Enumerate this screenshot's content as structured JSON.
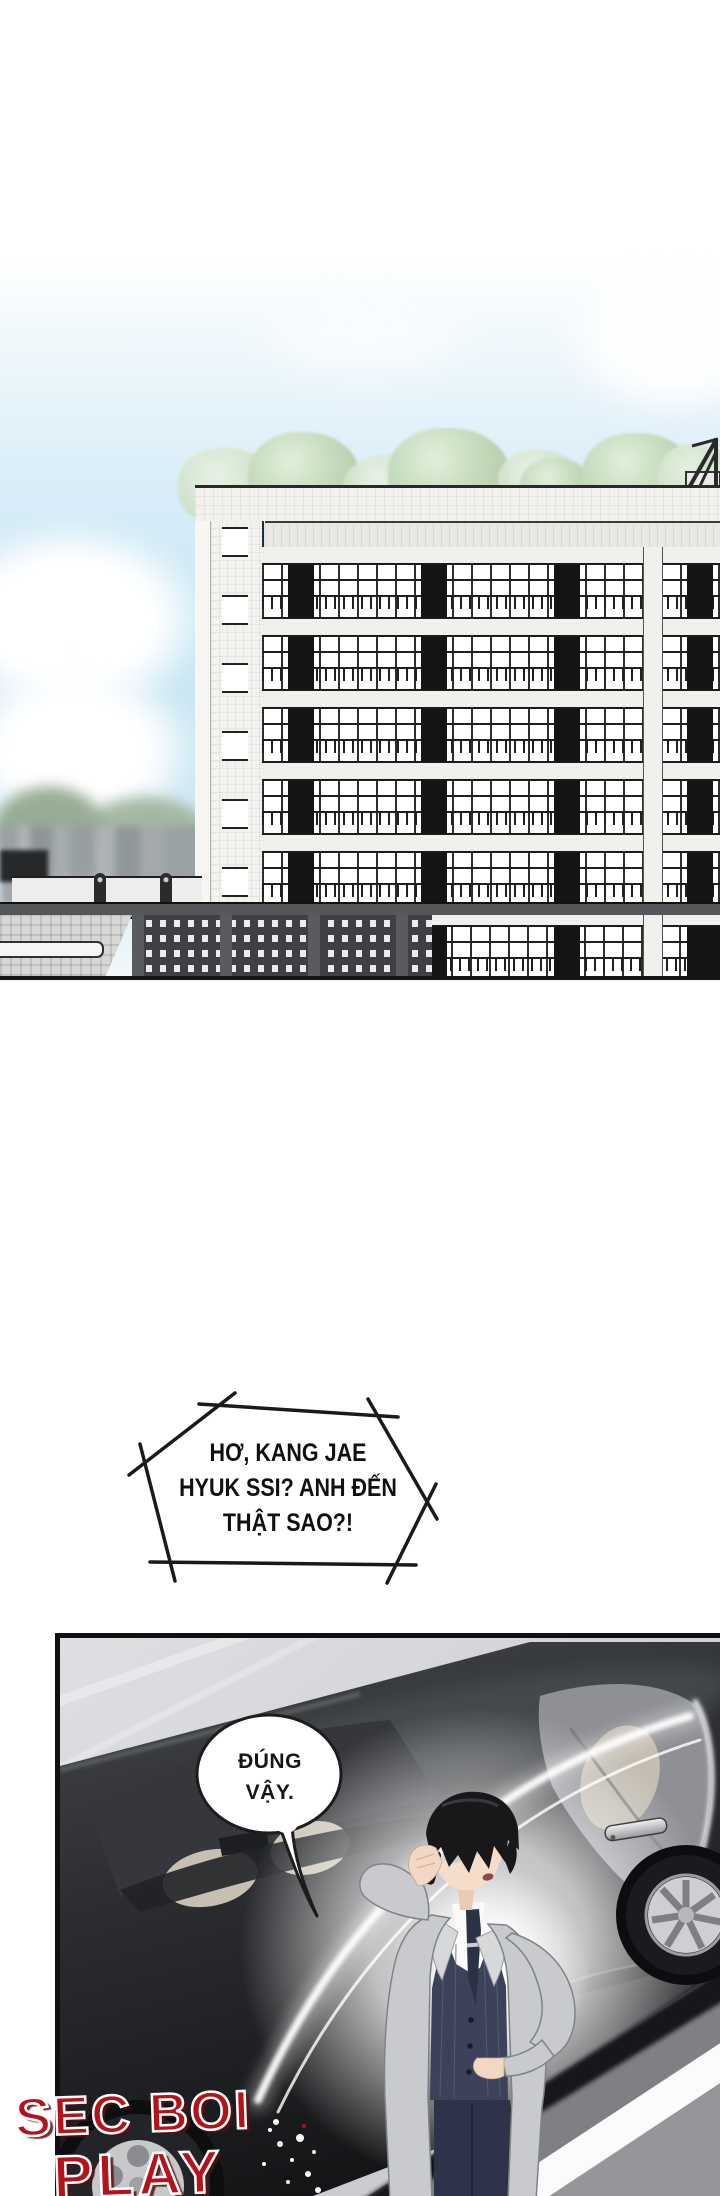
{
  "bubbles": {
    "shout": {
      "lines": [
        "HƠ, KANG JAE",
        "HYUK SSI? ANH ĐẾN",
        "THẬT SAO?!"
      ]
    },
    "reply": {
      "lines": [
        "ĐÚNG",
        "VẬY."
      ]
    }
  },
  "watermark": {
    "line1": "SEC BOI",
    "line2": "PLAY",
    "fill": "#b5121a",
    "outline": "#ffffff"
  },
  "palette": {
    "sky": "#cde8f4",
    "building_face": "#f1f0ed",
    "window_frame": "#1c1c1c",
    "dark_pillar": "#141414",
    "tree_green": "#c5dbbd",
    "parking_gray": "#3e4043",
    "car_body": "#26282b",
    "pavement": "#d6d8db",
    "glow": "#ffffff",
    "coat_gray": "#c8cacd",
    "vest_navy": "#3c4259",
    "skin": "#f4dac6",
    "road_gray": "#7e8083"
  }
}
